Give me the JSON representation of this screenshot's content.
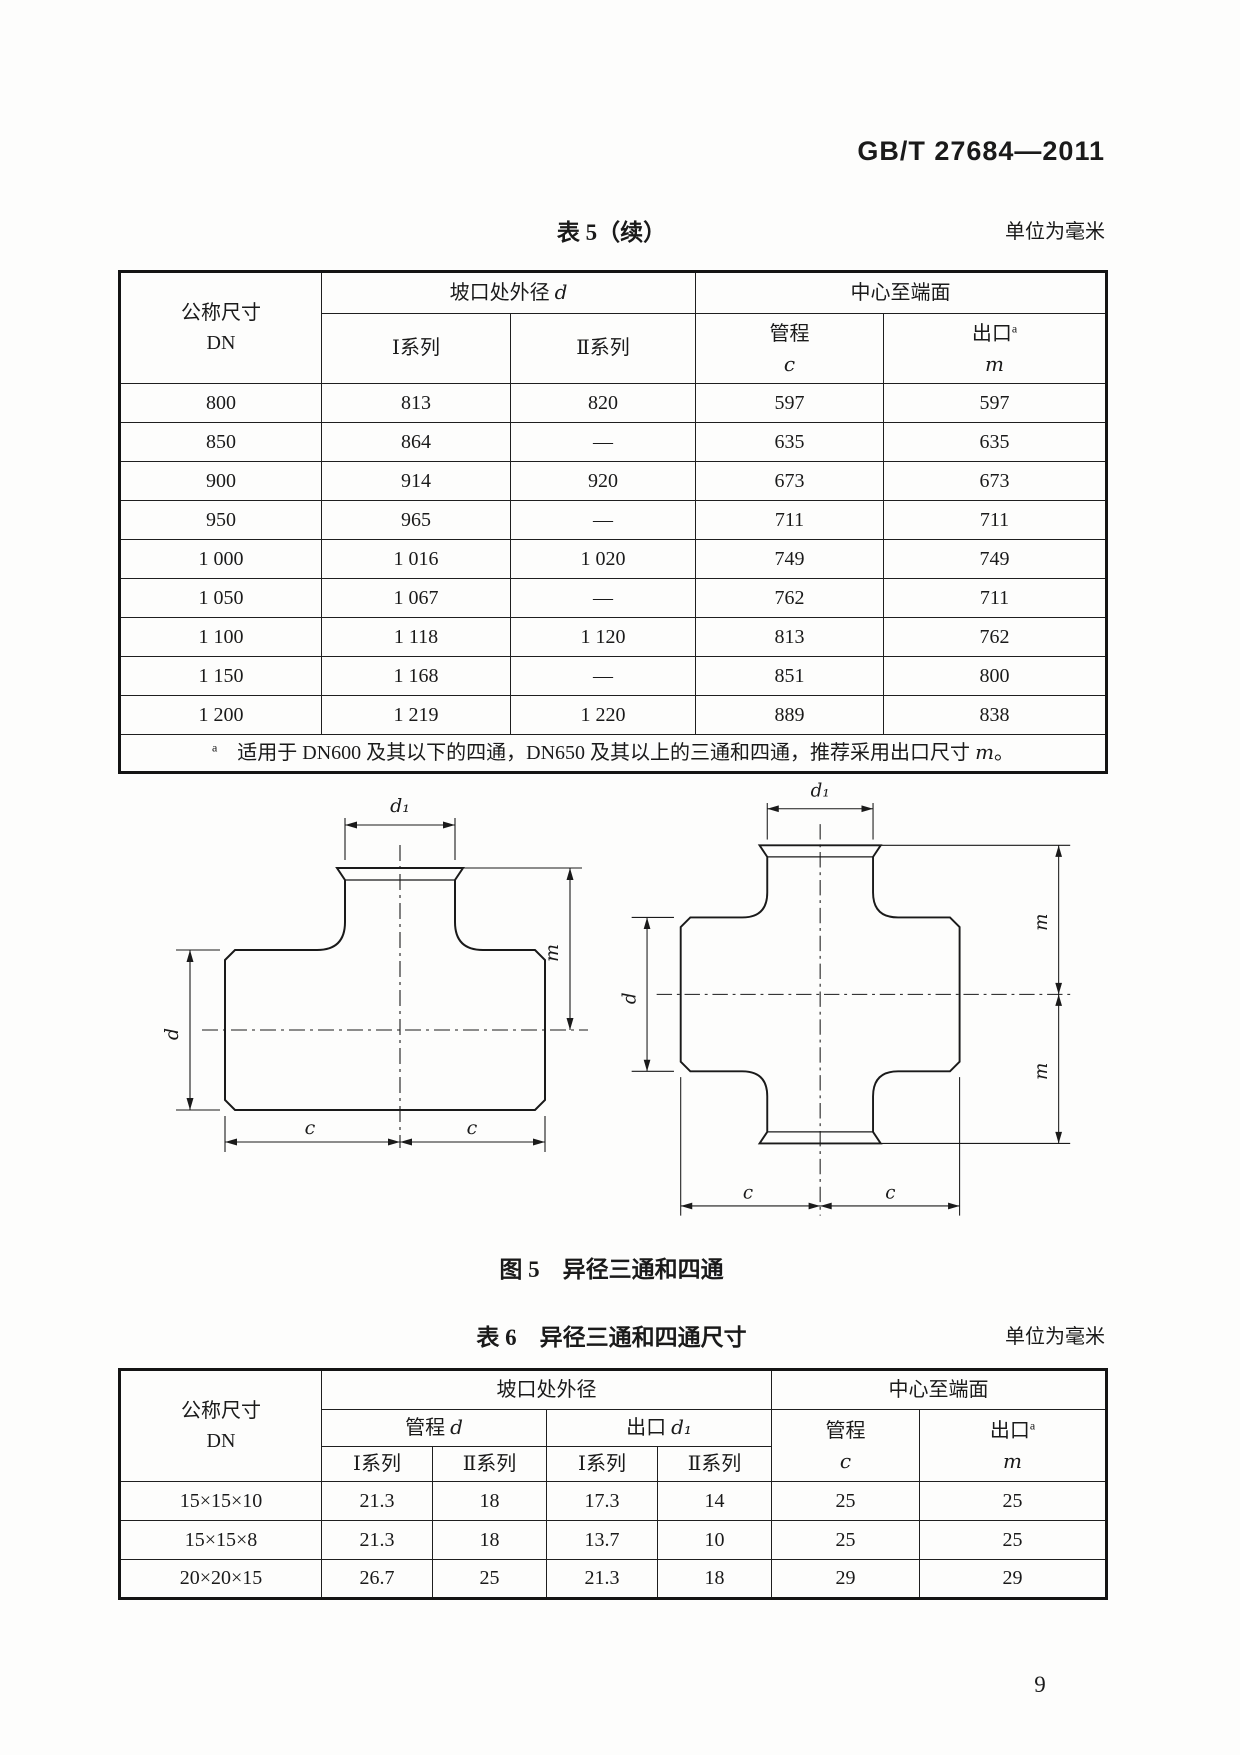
{
  "page": {
    "header": "GB/T 27684—2011",
    "page_number": "9"
  },
  "table5": {
    "title": "表 5（续）",
    "unit_note": "单位为毫米",
    "header": {
      "dn_line1": "公称尺寸",
      "dn_line2": "DN",
      "outer_diameter_group": "坡口处外径 ",
      "outer_diameter_var": "d",
      "center_to_end_group": "中心至端面",
      "series1": "Ⅰ系列",
      "series2": "Ⅱ系列",
      "run_label": "管程",
      "run_var": "c",
      "outlet_label": "出口",
      "outlet_sup": "a",
      "outlet_var": "m"
    },
    "rows": [
      [
        "800",
        "813",
        "820",
        "597",
        "597"
      ],
      [
        "850",
        "864",
        "—",
        "635",
        "635"
      ],
      [
        "900",
        "914",
        "920",
        "673",
        "673"
      ],
      [
        "950",
        "965",
        "—",
        "711",
        "711"
      ],
      [
        "1 000",
        "1 016",
        "1 020",
        "749",
        "749"
      ],
      [
        "1 050",
        "1 067",
        "—",
        "762",
        "711"
      ],
      [
        "1 100",
        "1 118",
        "1 120",
        "813",
        "762"
      ],
      [
        "1 150",
        "1 168",
        "—",
        "851",
        "800"
      ],
      [
        "1 200",
        "1 219",
        "1 220",
        "889",
        "838"
      ]
    ],
    "footnote": {
      "sup": "a",
      "text": "　适用于 DN600 及其以下的四通，DN650 及其以上的三通和四通，推荐采用出口尺寸 ",
      "var": "m",
      "end": "。"
    }
  },
  "figure5": {
    "caption": "图 5　异径三通和四通",
    "labels": {
      "d1": "d₁",
      "d": "d",
      "m": "m",
      "c": "c"
    }
  },
  "table6": {
    "title": "表 6　异径三通和四通尺寸",
    "unit_note": "单位为毫米",
    "header": {
      "dn_line1": "公称尺寸",
      "dn_line2": "DN",
      "outer_diameter_group": "坡口处外径",
      "center_to_end_group": "中心至端面",
      "run_d_label": "管程 ",
      "run_d_var": "d",
      "outlet_d_label": "出口 ",
      "outlet_d_var": "d₁",
      "series1": "Ⅰ系列",
      "series2": "Ⅱ系列",
      "run_label": "管程",
      "run_var": "c",
      "outlet_label": "出口",
      "outlet_sup": "a",
      "outlet_var": "m"
    },
    "rows": [
      [
        "15×15×10",
        "21.3",
        "18",
        "17.3",
        "14",
        "25",
        "25"
      ],
      [
        "15×15×8",
        "21.3",
        "18",
        "13.7",
        "10",
        "25",
        "25"
      ],
      [
        "20×20×15",
        "26.7",
        "25",
        "21.3",
        "18",
        "29",
        "29"
      ]
    ]
  }
}
